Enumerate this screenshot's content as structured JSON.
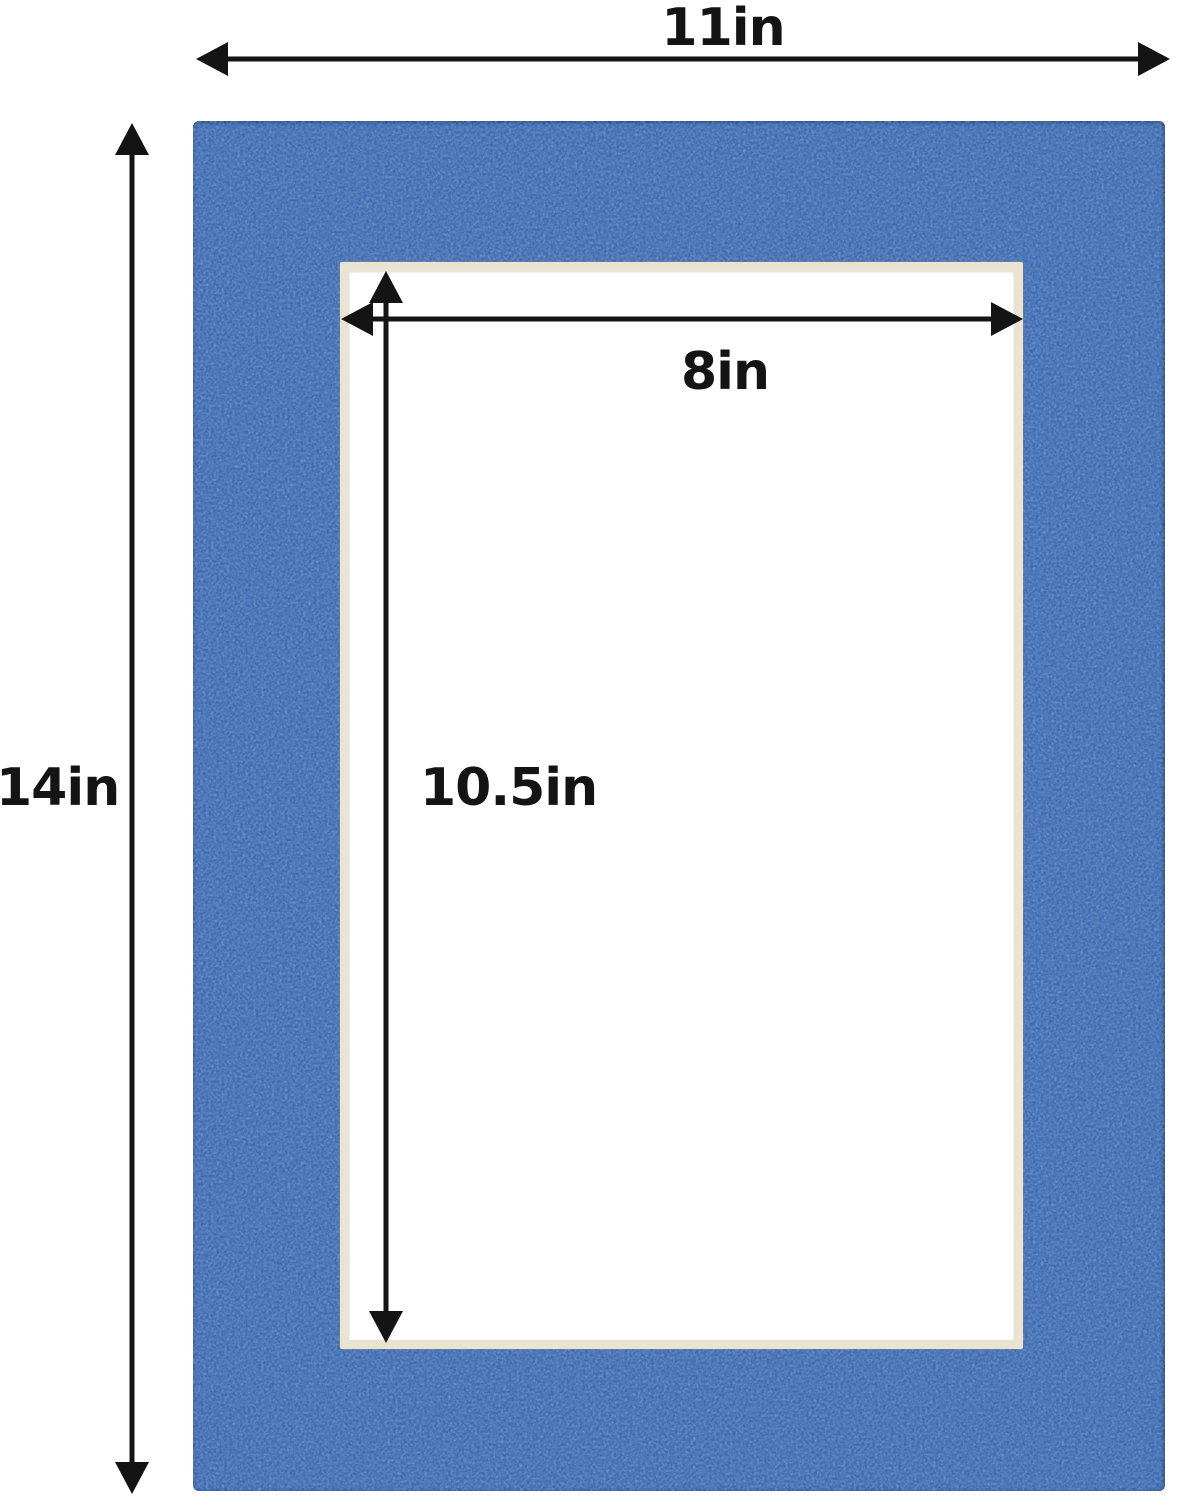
{
  "colors": {
    "background": "#ffffff",
    "mat_blue": "#3e6bb2",
    "mat_edge": "#27497f",
    "bevel_cream": "#eae3d1",
    "opening_white": "#ffffff",
    "arrow_black": "#141414"
  },
  "dimensions": {
    "outer_width_label": "11in",
    "outer_height_label": "14in",
    "opening_width_label": "8in",
    "opening_height_label": "10.5in"
  }
}
